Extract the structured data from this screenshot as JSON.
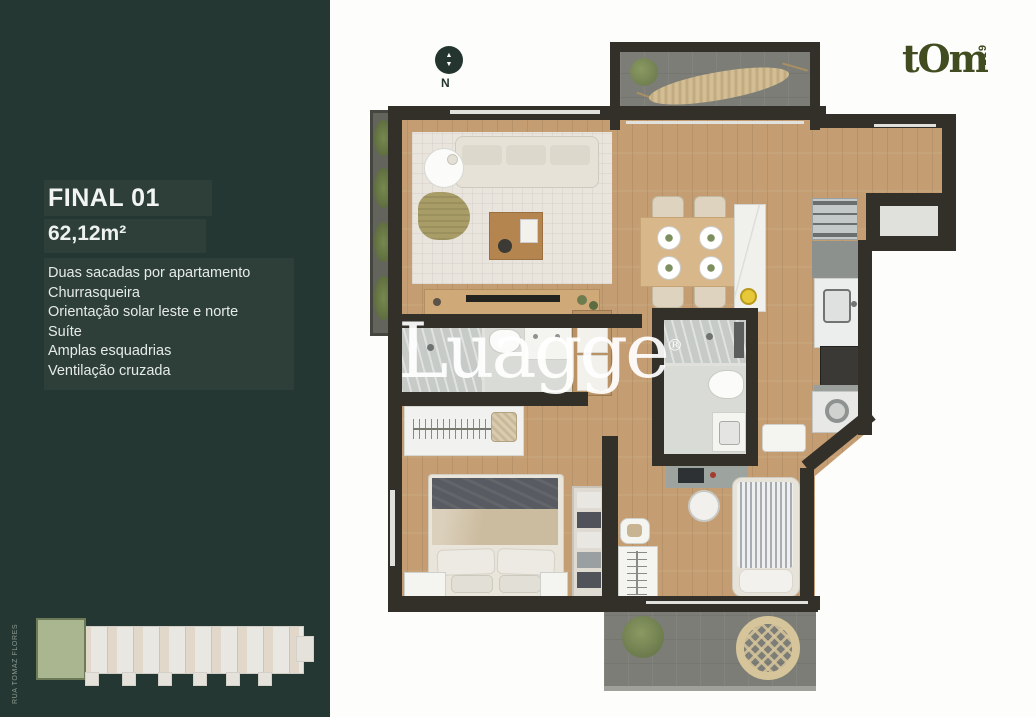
{
  "sidebar": {
    "title": "FINAL 01",
    "area": "62,12m²",
    "features": [
      "Duas sacadas por apartamento",
      "Churrasqueira",
      "Orientação solar leste e norte",
      "Suíte",
      "Amplas esquadrias",
      "Ventilação cruzada"
    ],
    "street_label": "RUA TOMAZ FLORES",
    "panel_color": "#253732"
  },
  "compass": {
    "label": "N"
  },
  "brand": {
    "name": "tOm",
    "unit_number": "219",
    "color": "#414d21"
  },
  "watermark": {
    "text": "Luagge",
    "mark": "®"
  },
  "floorplan": {
    "colors": {
      "wall": "#33302a",
      "wood_floor": "#c49d72",
      "balcony_floor": "#7b7d76",
      "bath_tile": "#d9dbd6",
      "rug": "#e9e5dd",
      "keyplan_highlight": "#a9b68f",
      "fruit_bowl": "#e6c838"
    },
    "rooms": [
      "top-balcony-hammock",
      "living-room",
      "dining-area",
      "kitchen",
      "suite-bathroom",
      "social-bathroom",
      "closet",
      "master-bedroom",
      "second-bedroom",
      "laundry-corner",
      "bottom-balcony",
      "side-planter"
    ]
  }
}
